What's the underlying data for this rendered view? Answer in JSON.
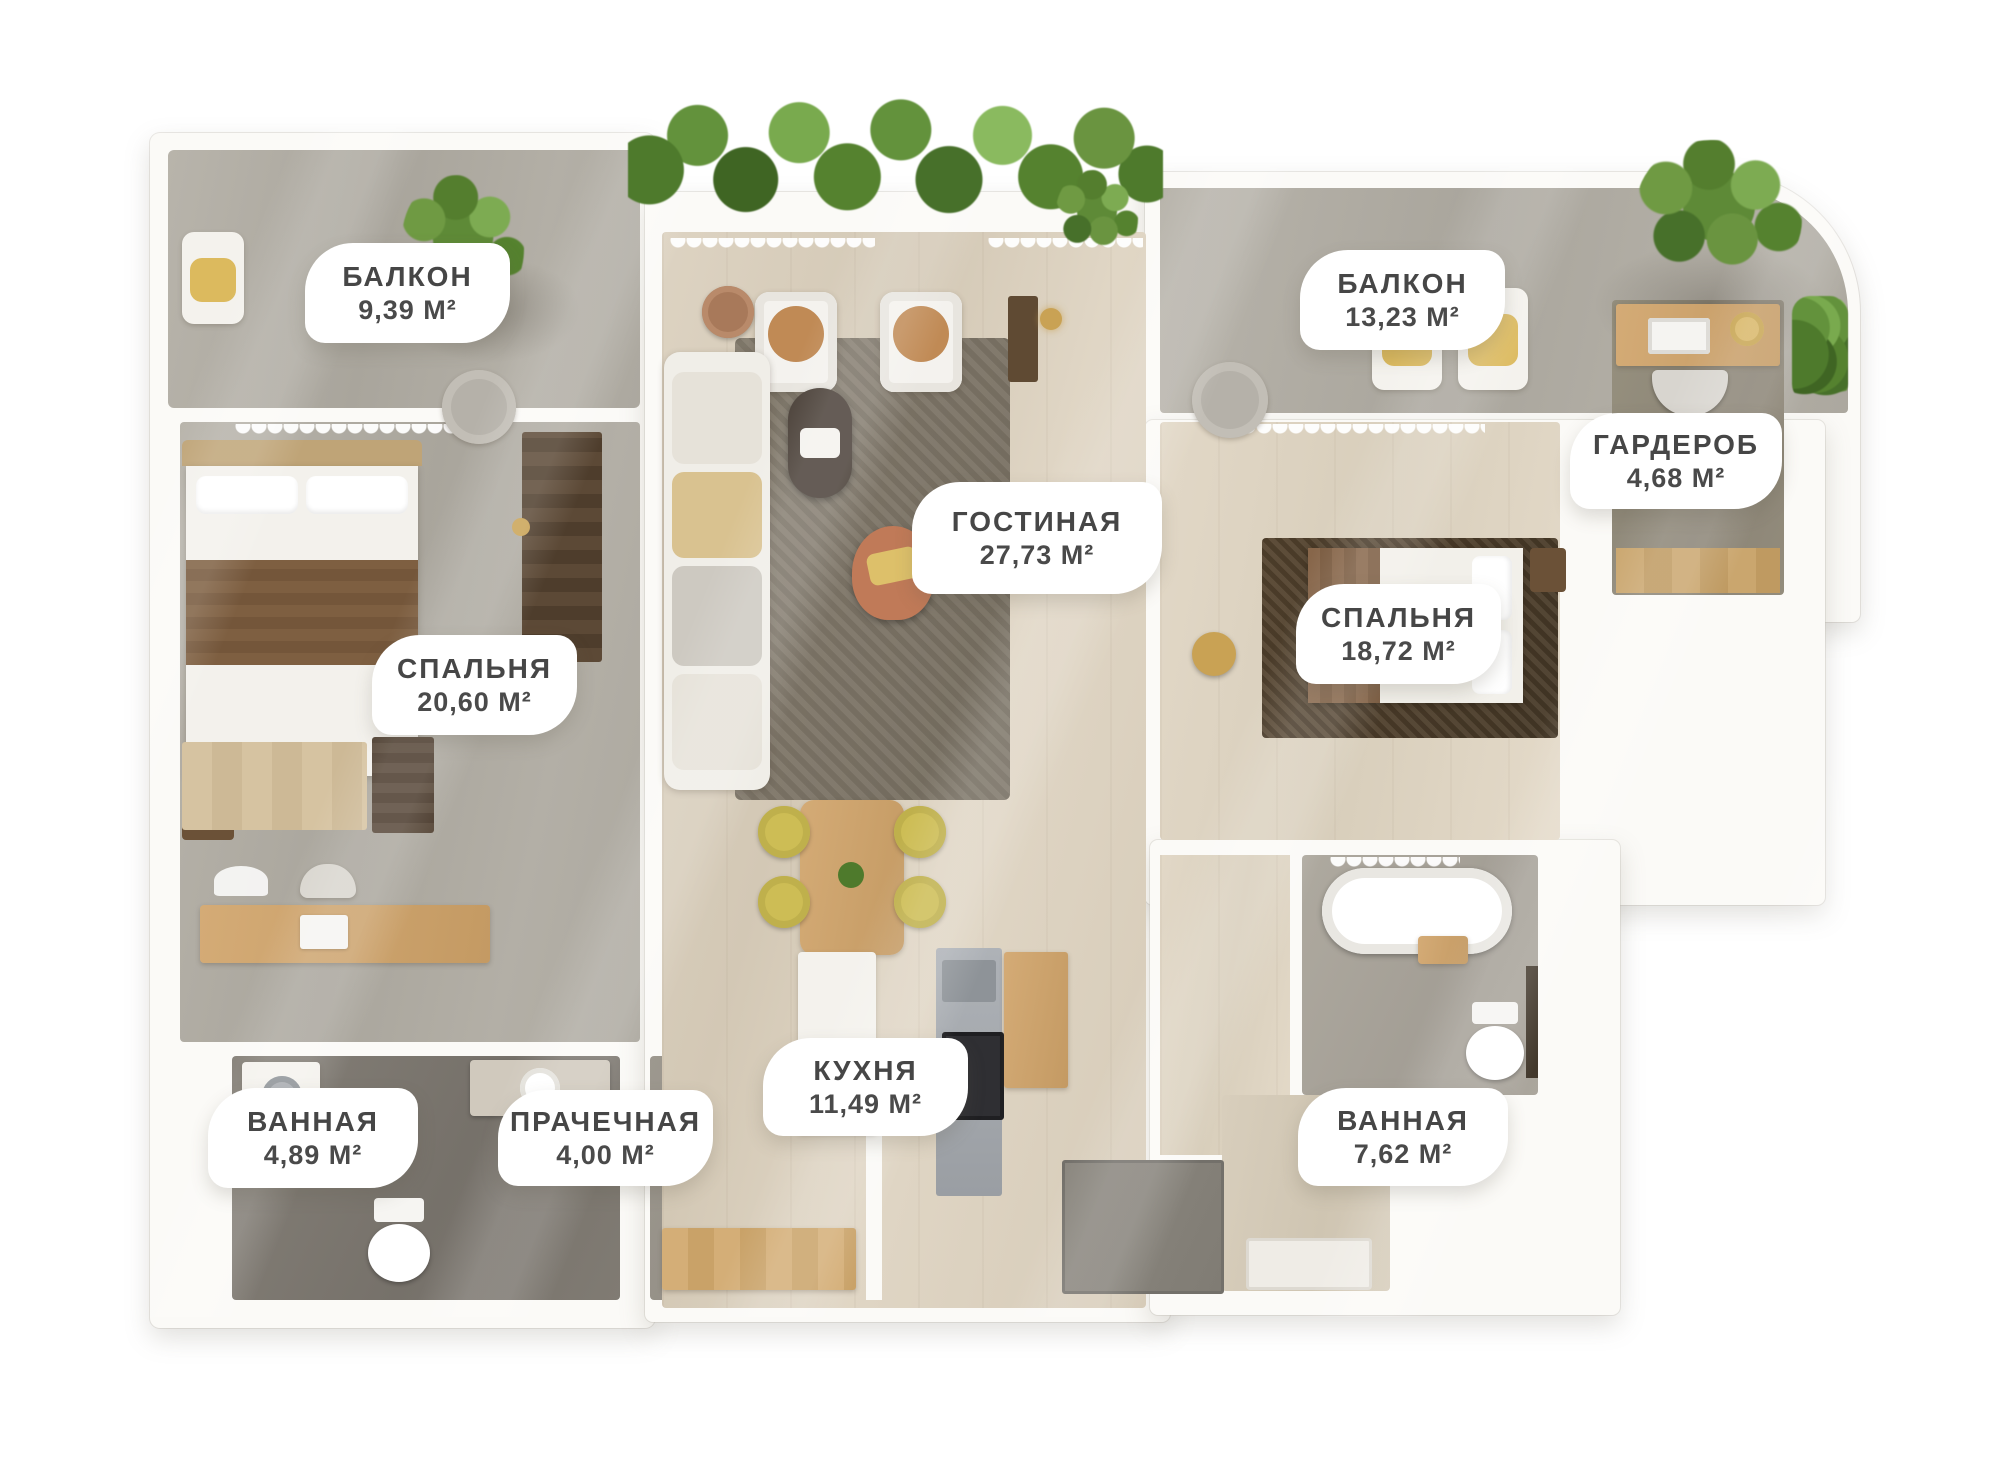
{
  "plan_type": "apartment-floorplan-3d-top-view",
  "rooms": [
    {
      "key": "balcony-left",
      "label": "БАЛКОН",
      "area": "9,39 М²"
    },
    {
      "key": "living-room",
      "label": "ГОСТИНАЯ",
      "area": "27,73 М²"
    },
    {
      "key": "balcony-right",
      "label": "БАЛКОН",
      "area": "13,23 М²"
    },
    {
      "key": "wardrobe",
      "label": "ГАРДЕРОБ",
      "area": "4,68 М²"
    },
    {
      "key": "bedroom-left",
      "label": "СПАЛЬНЯ",
      "area": "20,60 М²"
    },
    {
      "key": "bedroom-right",
      "label": "СПАЛЬНЯ",
      "area": "18,72 М²"
    },
    {
      "key": "bathroom-left",
      "label": "ВАННАЯ",
      "area": "4,89 М²"
    },
    {
      "key": "laundry",
      "label": "ПРАЧЕЧНАЯ",
      "area": "4,00 М²"
    },
    {
      "key": "kitchen",
      "label": "КУХНЯ",
      "area": "11,49 М²"
    },
    {
      "key": "bathroom-right",
      "label": "ВАННАЯ",
      "area": "7,62 М²"
    }
  ],
  "palette": {
    "background": "#ffffff",
    "walls": "#fbfaf7",
    "concrete_floor": "#aca89f",
    "wood_floor": "#d8cebb",
    "dark_bath_floor": "#7b766e",
    "label_text": "#464646",
    "greenery": "#5e8a37",
    "terracotta_accent": "#c07a58",
    "yellow_accent": "#d8bd60"
  }
}
